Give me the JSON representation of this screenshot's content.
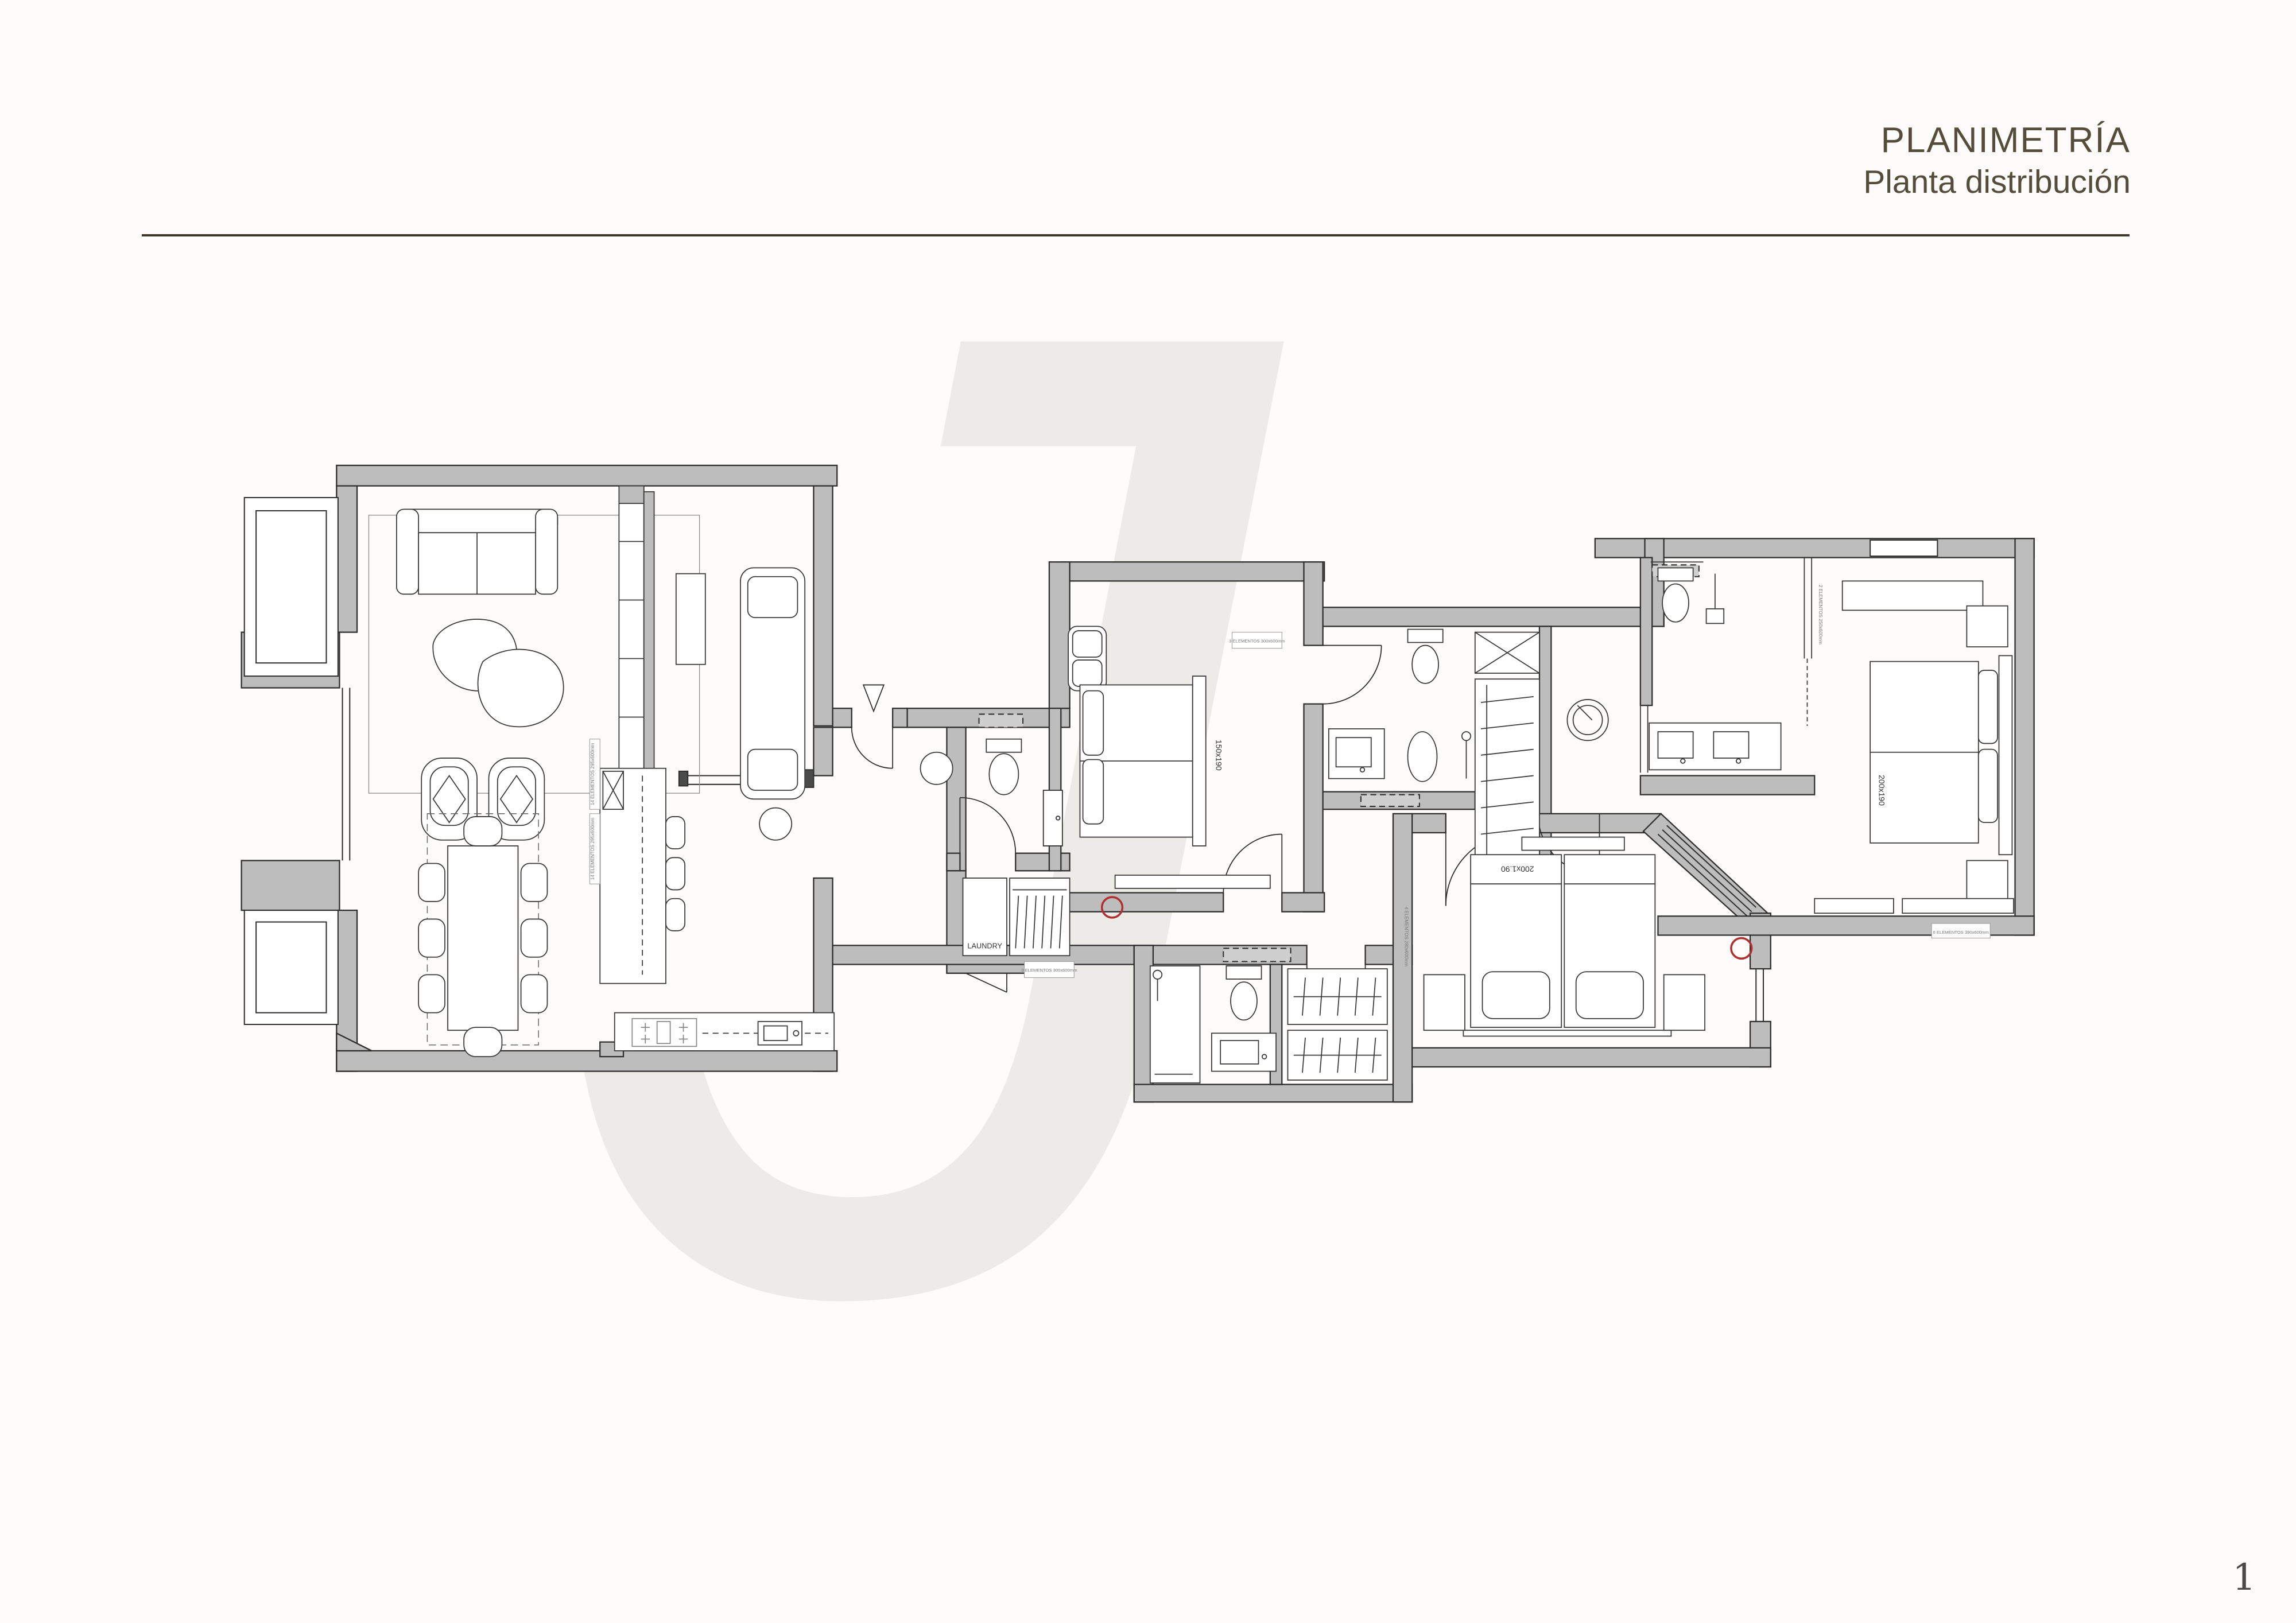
{
  "page": {
    "background": "#fdfcfa",
    "number": "1",
    "number_color": "#4a4a4a"
  },
  "header": {
    "title": "PLANIMETRÍA",
    "subtitle": "Planta distribución",
    "text_color": "#544d3b",
    "rule_color": "#3e382c"
  },
  "watermark": {
    "letter": "J",
    "color": "#edebe7"
  },
  "plan": {
    "wall_fill": "#bdbdbd",
    "line_color": "#2f2f2f",
    "marker_color": "#b03030",
    "labels": {
      "laundry": "LAUNDRY",
      "bed1": "150x190",
      "master_bed": "200x190",
      "twin_bed": "200x1.90",
      "elem_island_1": "14 ELEMENTOS 295x600mm",
      "elem_island_2": "14 ELEMENTOS 295x600mm",
      "elem_hall_top": "3 ELEMENTOS 300x600mm",
      "elem_hall_bottom": "3 ELEMENTOS 300x600mm",
      "elem_corridor": "4 ELEMENTOS 280x600mm",
      "elem_master_bath": "2 ELEMENTOS 250x600mm",
      "elem_master_bottom": "6 ELEMENTOS 390x600mm"
    }
  }
}
